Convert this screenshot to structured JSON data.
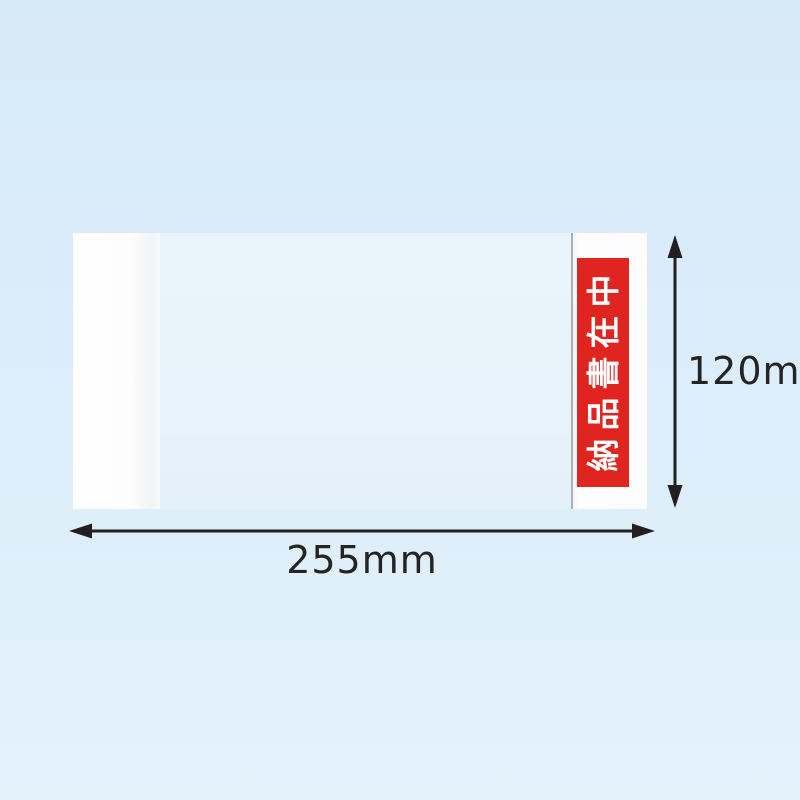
{
  "product": {
    "description": "transparent delivery document envelope",
    "contents_label": {
      "text": "納品書在中",
      "bg_color": "#e02420",
      "text_color": "#ffffff"
    }
  },
  "dimensions": {
    "width_label": "255mm",
    "height_label": "120mm",
    "arrow_color": "#231f20",
    "label_text_color": "#262323"
  },
  "colors": {
    "background_top": "#d7eaf8",
    "background_bottom": "#e4f2fc",
    "envelope_body": "#e8f3fb",
    "envelope_flap": "#fdfdfd",
    "panel_edge_line": "#7d8791"
  }
}
